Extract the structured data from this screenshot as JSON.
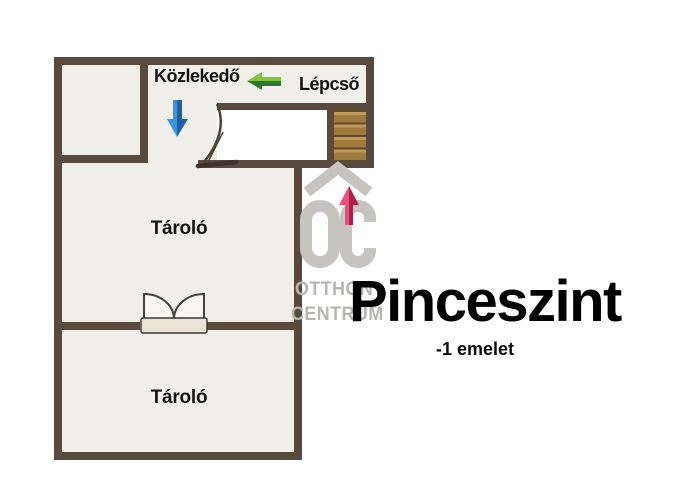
{
  "title": {
    "text": "Pinceszint",
    "subtitle": "-1 emelet"
  },
  "floorplan": {
    "rooms": [
      {
        "id": "kozlekedo",
        "label": "Közlekedő"
      },
      {
        "id": "lepcso",
        "label": "Lépcső"
      },
      {
        "id": "tarolo_upper",
        "label": "Tároló"
      },
      {
        "id": "tarolo_lower",
        "label": "Tároló"
      }
    ],
    "icons": [
      "left-arrow-icon",
      "down-arrow-icon",
      "up-arrow-icon",
      "stairs-treads",
      "door-swing-arc",
      "double-door-symbol"
    ]
  },
  "watermark": {
    "logo": "OC",
    "line1": "OTTHON",
    "line2": "CENTRUM"
  },
  "colors": {
    "wall": "#594a3d",
    "floor": "#f1efe9",
    "stairs_wood": "#9f7a3d",
    "stairs_divider": "#5e4b2d",
    "arrow_green_light": "#86c440",
    "arrow_green_dark": "#277a31",
    "arrow_blue_light": "#3f93da",
    "arrow_blue_dark": "#1b61a8",
    "arrow_red_light": "#e8507a",
    "arrow_red_dark": "#b01e4c",
    "watermark_gray": "#c6c4c1",
    "door_slab": "#eae4d7",
    "title_black": "#000000"
  }
}
